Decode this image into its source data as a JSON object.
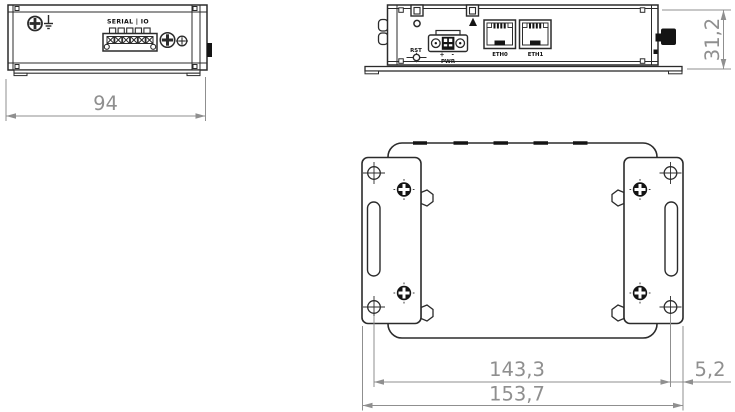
{
  "drawing": {
    "background": "#ffffff",
    "line_color": "#2b2b2b",
    "dimension_color": "#8f8f8f",
    "views": {
      "side": {
        "serial_io_label": "SERIAL | IO",
        "width_dimension": "94"
      },
      "front": {
        "rst_label": "RST",
        "pwr_polarity": "+ -",
        "pwr_label": "PWR",
        "eth0_label": "ETH0",
        "eth1_label": "ETH1",
        "height_dimension": "31,2"
      },
      "bottom": {
        "hole_distance_dimension": "143,3",
        "hole_edge_offset_dimension": "5,2",
        "overall_width_dimension": "153,7"
      }
    },
    "icons": {
      "ground_screw": "ground-screw-icon",
      "earth_symbol": "earth-ground-icon",
      "antenna_mark": "antenna-triangle-icon",
      "phillips_screw": "phillips-screw-icon",
      "mounting_hole": "crosshair-hole-icon"
    }
  }
}
